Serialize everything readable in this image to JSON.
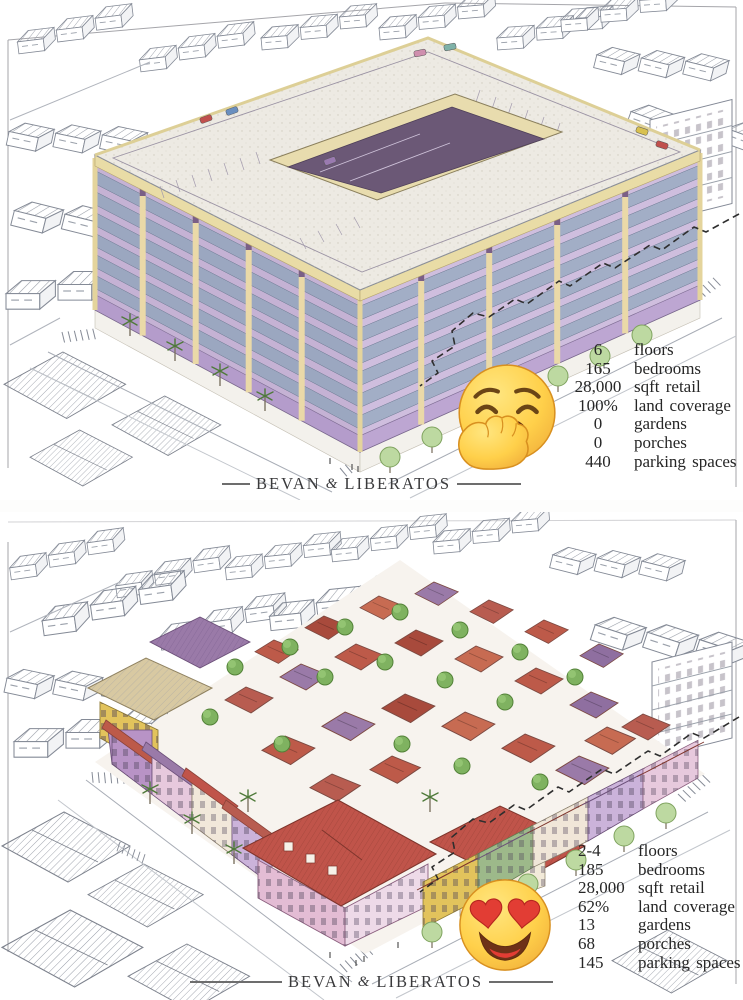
{
  "brand": {
    "first": "BEVAN",
    "ampersand": "&",
    "second": "LIBERATOS"
  },
  "panels": [
    {
      "name": "six-story-block",
      "emoji": "yawning-face",
      "stats": [
        {
          "value": "6",
          "label": "floors"
        },
        {
          "value": "165",
          "label": "bedrooms"
        },
        {
          "value": "28,000",
          "label": "sqft retail"
        },
        {
          "value": "100%",
          "label": "land coverage"
        },
        {
          "value": "0",
          "label": "gardens"
        },
        {
          "value": "0",
          "label": "porches"
        },
        {
          "value": "440",
          "label": "parking spaces"
        }
      ]
    },
    {
      "name": "fine-grained-neighborhood",
      "emoji": "smiling-face-with-heart-eyes",
      "stats": [
        {
          "value": "2-4",
          "label": "floors"
        },
        {
          "value": "185",
          "label": "bedrooms"
        },
        {
          "value": "28,000",
          "label": "sqft retail"
        },
        {
          "value": "62%",
          "label": "land coverage"
        },
        {
          "value": "13",
          "label": "gardens"
        },
        {
          "value": "68",
          "label": "porches"
        },
        {
          "value": "145",
          "label": "parking spaces"
        }
      ]
    }
  ],
  "colors": {
    "paper": "#ffffff",
    "sketch_ink": "#878c97",
    "facade_lavender": "#c5b2d4",
    "cornice_cream": "#e9dca6",
    "window_blue": "#93a4bc",
    "roof_red": "#c0544a",
    "roof_purple": "#9a7aa8",
    "wall_yellow": "#e2c35c",
    "wall_pink": "#e3bcd4",
    "tree_green": "#7fb260",
    "emoji_yellow": "#ffd04a",
    "heart_red": "#e23d34",
    "text_ink": "#262626"
  }
}
